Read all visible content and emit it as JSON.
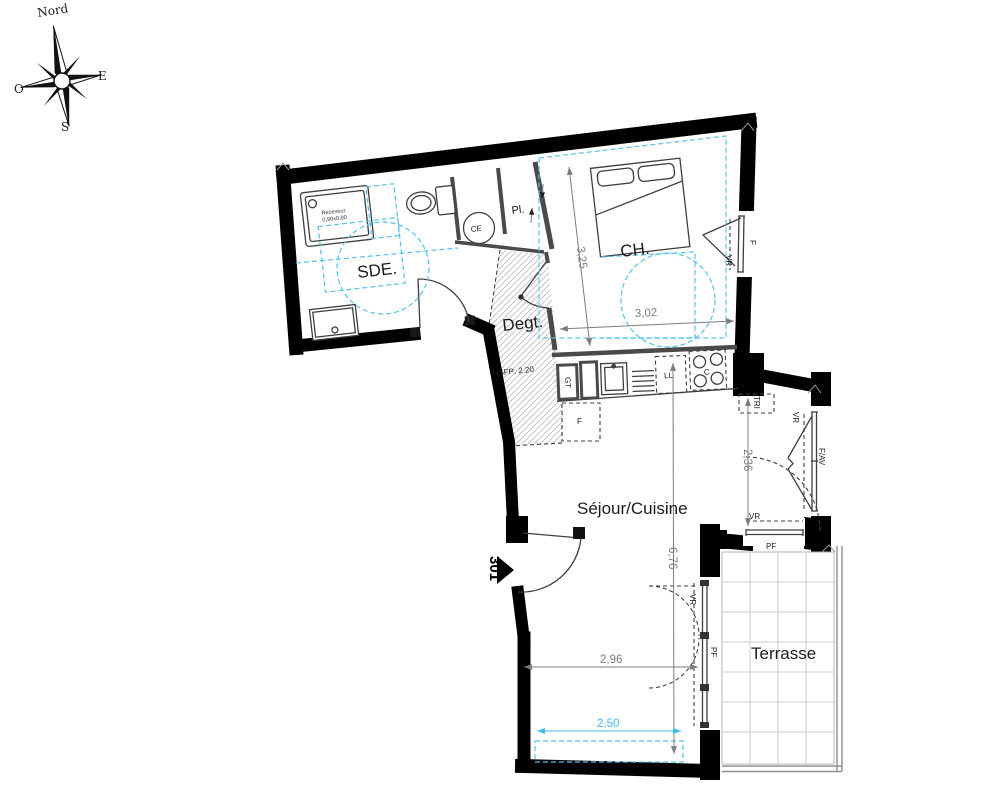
{
  "plan": {
    "unit_number": "301",
    "compass": {
      "north": "Nord",
      "east": "E",
      "south": "S",
      "west": "O"
    },
    "rooms": {
      "sde": "SDE.",
      "ch": "CH.",
      "degt": "Degt.",
      "sejour": "Séjour/Cuisine",
      "terrasse": "Terrasse"
    },
    "annotations": {
      "pl": "Pl.",
      "ce": "CE",
      "hsfp": "HSFP: 2.20",
      "receveur_line1": "Receveur",
      "receveur_line2": "0,90x0,90",
      "ll": "LL",
      "cooktop": "C",
      "fridge": "F",
      "gt": "GT",
      "tri": "TRI",
      "window_f": "F",
      "vr": "VR",
      "fav": "F/AV",
      "pf": "PF"
    },
    "dimensions": {
      "ch_depth": "3,25",
      "ch_width": "3,02",
      "kitchen_bay": "2,36",
      "sejour_length": "6,76",
      "sejour_width": "2,96",
      "terrace_front": "2,50"
    },
    "colors": {
      "wall": "#000000",
      "dim_gray": "#7d7d7d",
      "accessibility_blue": "#54c3ee"
    }
  }
}
